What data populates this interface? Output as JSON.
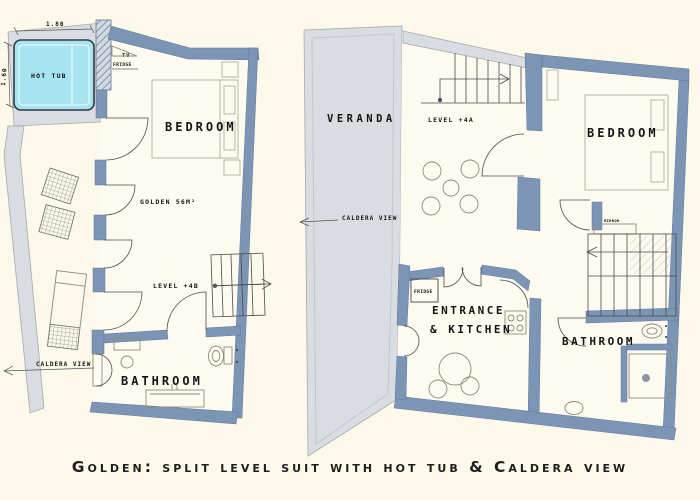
{
  "caption": "Golden: split level suit with hot tub & Caldera view",
  "colors": {
    "background": "#fcf8ea",
    "floor": "#fdfaf0",
    "wall": "#7d95b5",
    "surround": "#d9dce0",
    "surround-border": "#a4aab2",
    "hot-tub": "#a8e4ef",
    "furniture": "#8f8a77",
    "text": "#141414"
  },
  "left_plan": {
    "name": "lower level plan",
    "labels": {
      "hot_tub": "HOT TUB",
      "dim_width": "1.80",
      "dim_height": "1.60",
      "tv": "TV",
      "fridge": "FRIDGE",
      "bedroom": "BEDROOM",
      "area": "GOLDEN 56M²",
      "level": "LEVEL +4B",
      "caldera_view": "CALDERA VIEW",
      "bathroom": "BATHROOM"
    }
  },
  "right_plan": {
    "name": "upper level plan",
    "labels": {
      "veranda": "VERANDA",
      "level": "LEVEL +4A",
      "caldera_view": "CALDERA VIEW",
      "bedroom": "BEDROOM",
      "mirror": "MIRROR",
      "entrance_line1": "ENTRANCE",
      "entrance_line2": "&  KITCHEN",
      "fridge": "FRIDGE",
      "bathroom": "BATHROOM"
    }
  }
}
